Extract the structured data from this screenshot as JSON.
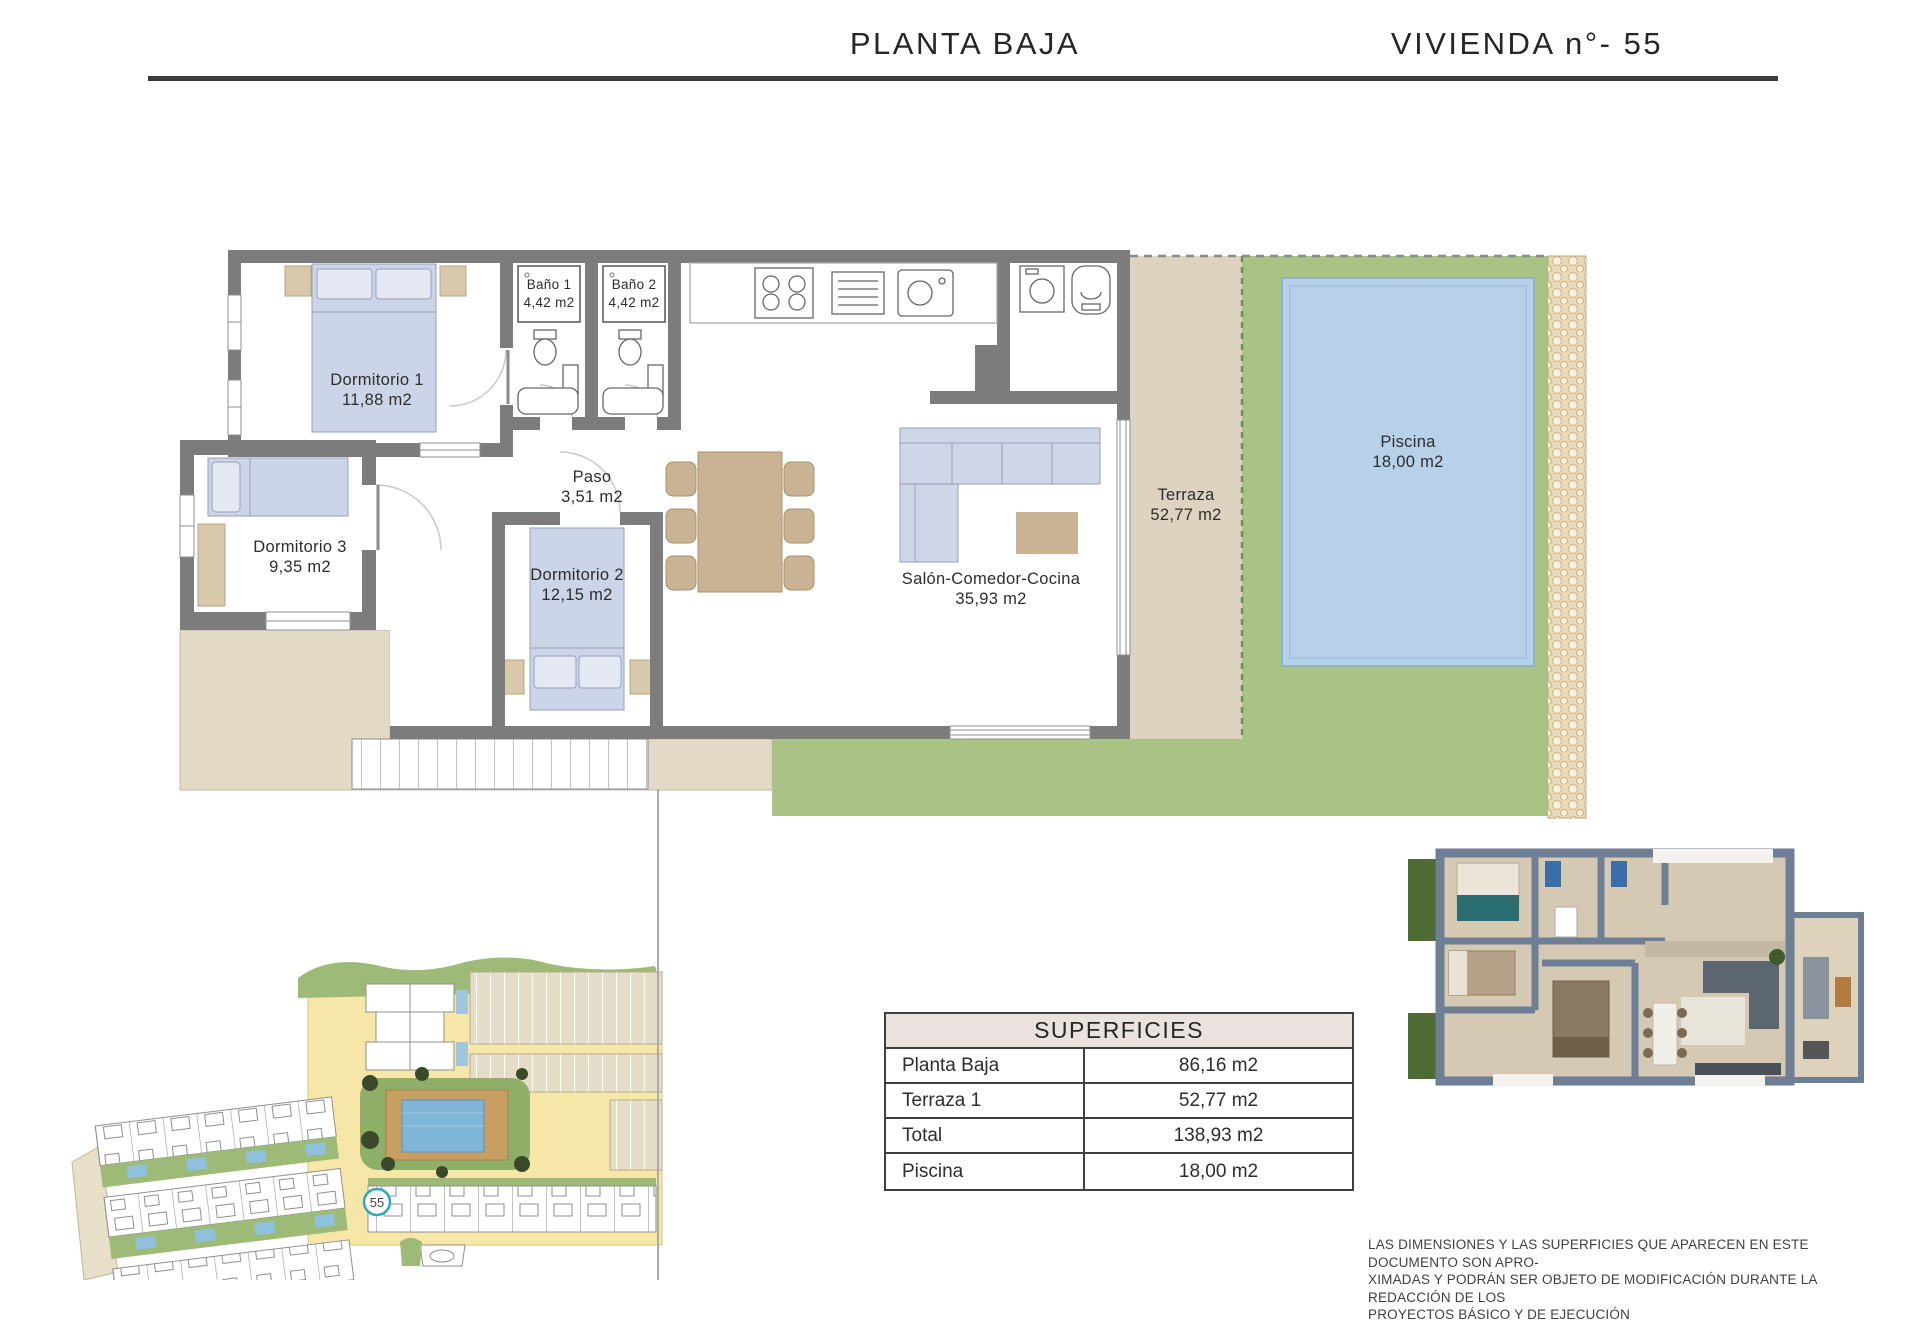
{
  "header": {
    "title_left": "PLANTA BAJA",
    "title_right": "VIVIENDA n°- 55"
  },
  "floor_plan": {
    "rooms": [
      {
        "name": "Dormitorio 1",
        "area": "11,88 m2"
      },
      {
        "name": "Baño 1",
        "area": "4,42 m2"
      },
      {
        "name": "Baño 2",
        "area": "4,42 m2"
      },
      {
        "name": "Paso",
        "area": "3,51 m2"
      },
      {
        "name": "Dormitorio 3",
        "area": "9,35 m2"
      },
      {
        "name": "Dormitorio 2",
        "area": "12,15 m2"
      },
      {
        "name": "Salón-Comedor-Cocina",
        "area": "35,93 m2"
      },
      {
        "name": "Terraza",
        "area": "52,77 m2"
      },
      {
        "name": "Piscina",
        "area": "18,00 m2"
      }
    ]
  },
  "site_plan": {
    "unit_badge": "55"
  },
  "surfaces_table": {
    "title": "SUPERFICIES",
    "rows": [
      {
        "label": "Planta Baja",
        "value": "86,16 m2"
      },
      {
        "label": "Terraza 1",
        "value": "52,77 m2"
      },
      {
        "label": "Total",
        "value": "138,93 m2"
      },
      {
        "label": "Piscina",
        "value": "18,00 m2"
      }
    ]
  },
  "disclaimer": {
    "line1": "LAS DIMENSIONES Y LAS SUPERFICIES QUE APARECEN EN ESTE DOCUMENTO SON APRO-",
    "line2": "XIMADAS Y PODRÁN SER OBJETO DE MODIFICACIÓN DURANTE LA REDACCIÓN DE LOS",
    "line3": "PROYECTOS BÁSICO Y DE EJECUCIÓN"
  },
  "colors": {
    "wall_gray": "#7c7c7c",
    "terrace_beige": "#ddd3c0",
    "patio_beige": "#e2d9c6",
    "grass_green": "#a8c383",
    "pool_blue": "#b7d1e9",
    "furniture_blue": "#ccd4e7",
    "furniture_tan": "#d9c9ac",
    "badge_teal": "#2fa8bc",
    "rule_dark": "#3b3b3b"
  }
}
